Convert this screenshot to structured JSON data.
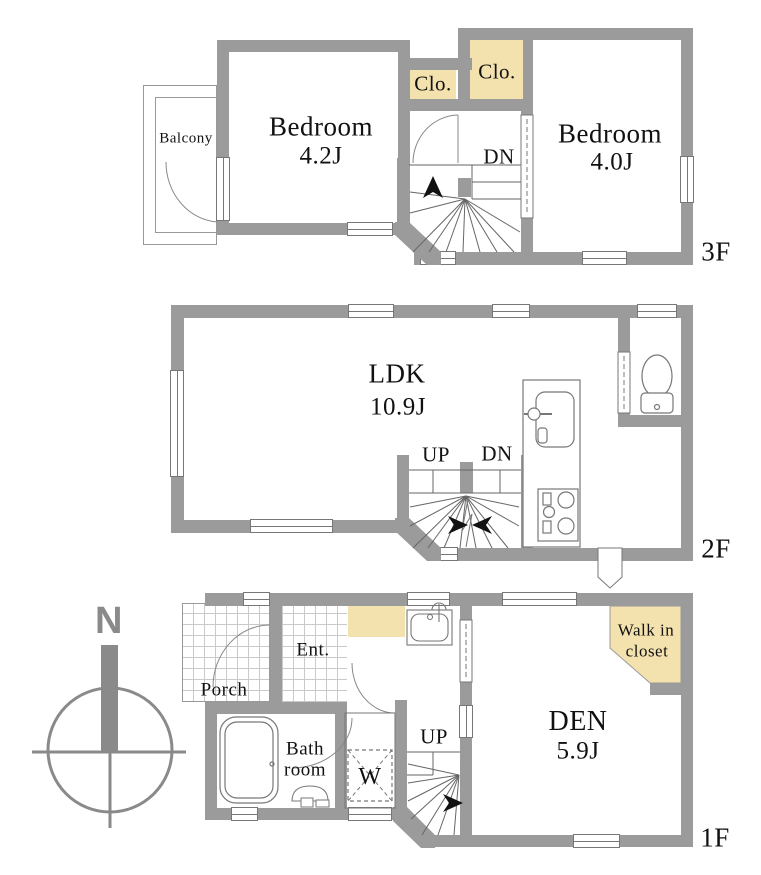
{
  "colors": {
    "wall": "#9b9b9b",
    "closet_fill": "#f3e1ae",
    "fixture_line": "#777777",
    "text": "#111111",
    "compass_gray": "#8a8a8a"
  },
  "compass": {
    "north_label": "N"
  },
  "floor3": {
    "floor_label": "3F",
    "balcony": "Balcony",
    "bedroom1_name": "Bedroom",
    "bedroom1_size": "4.2J",
    "bedroom2_name": "Bedroom",
    "bedroom2_size": "4.0J",
    "closet1": "Clo.",
    "closet2": "Clo.",
    "down": "DN"
  },
  "floor2": {
    "floor_label": "2F",
    "ldk_name": "LDK",
    "ldk_size": "10.9J",
    "up": "UP",
    "down": "DN"
  },
  "floor1": {
    "floor_label": "1F",
    "porch": "Porch",
    "entrance": "Ent.",
    "bath_line1": "Bath",
    "bath_line2": "room",
    "washer": "W",
    "up": "UP",
    "den_name": "DEN",
    "den_size": "5.9J",
    "wic_line1": "Walk in",
    "wic_line2": "closet"
  }
}
